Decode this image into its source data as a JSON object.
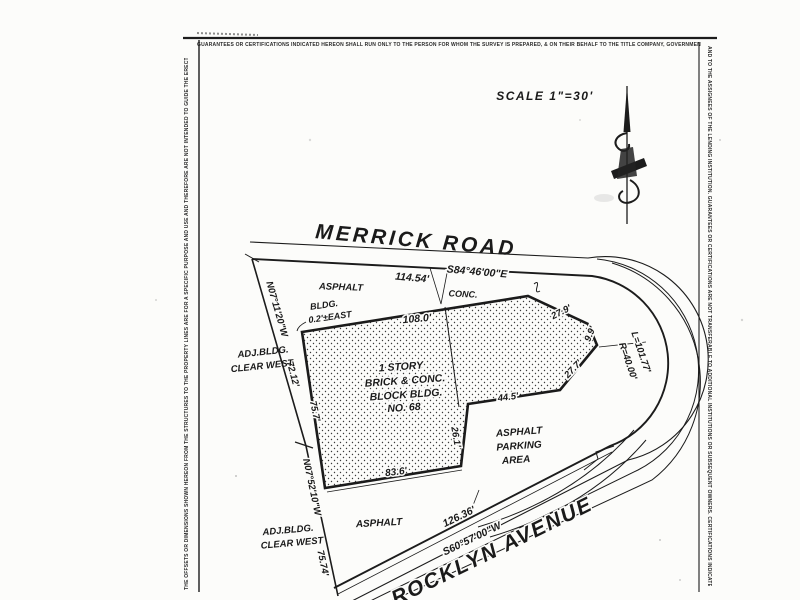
{
  "sheet": {
    "top_disclaimer": "GUARANTEES OR CERTIFICATIONS INDICATED HEREON SHALL RUN ONLY TO THE PERSON FOR WHOM THE SURVEY IS PREPARED, & ON THEIR BEHALF TO THE TITLE COMPANY, GOVERNMENTAL AGENCY & LENDING INSTITUTION LISTED HEREON",
    "left_margin_note": "THE OFFSETS OR DIMENSIONS SHOWN HEREON FROM THE STRUCTURES TO THE PROPERTY LINES ARE FOR A SPECIFIC PURPOSE AND USE AND THEREFORE ARE NOT INTENDED TO GUIDE THE ERECTION OF FENCES, RETAINING WALLS, POOLS, PATIOS, PLANTING AREAS, ADDITIONS TO BUILDINGS & ANY OTHER CONSTRUCTION",
    "right_margin_note": "AND TO THE ASSIGNEES OF THE LENDING INSTITUTION. GUARANTEES OR CERTIFICATIONS ARE NOT TRANSFERABLE TO ADDITIONAL INSTITUTIONS OR SUBSEQUENT OWNERS. CERTIFICATIONS INDICATED HEREON SIGNIFY THAT THIS SURVEY WAS PREPARED IN ACCORDANCE WITH THE EXISTING CODE OF PRACTICE FOR LAND SURVEYS",
    "scale_label": "SCALE 1\"=30'"
  },
  "map": {
    "streets": {
      "merrick_road": "MERRICK ROAD",
      "rocklyn_avenue": "ROCKLYN AVENUE"
    },
    "boundary": {
      "merrick_bearing": "S84°46'00\"E",
      "merrick_distance": "114.54'",
      "west_upper_bearing": "N07°11'20\"W",
      "west_upper_distance": "72.12'",
      "west_lower_bearing": "N07°52'10\"W",
      "west_lower_distance": "75.74'",
      "rocklyn_bearing": "S60°57'00\"W",
      "rocklyn_distance": "126.36'",
      "corner_curve_length": "L=101.77'",
      "corner_curve_radius": "R=40.00'"
    },
    "building": {
      "name_lines": [
        "1 STORY",
        "BRICK & CONC.",
        "BLOCK BLDG.",
        "NO. 68"
      ],
      "front_width": "108.0'",
      "bevel": "27.9'",
      "corner_side": "9.9'",
      "bevel_back": "27.7'",
      "wing_back": "44.5'",
      "wing_depth": "26.1'",
      "rear_width": "83.6'",
      "west_depth": "75.7'"
    },
    "annotations": {
      "bldg_offset": [
        "BLDG.",
        "0.2'±EAST"
      ],
      "adj_bldg_north": [
        "ADJ.BLDG.",
        "CLEAR WEST"
      ],
      "adj_bldg_south": [
        "ADJ.BLDG.",
        "CLEAR WEST"
      ],
      "surface_asphalt_north": "ASPHALT",
      "surface_conc": "CONC.",
      "surface_asphalt_south": "ASPHALT",
      "parking_area": [
        "ASPHALT",
        "PARKING",
        "AREA"
      ]
    },
    "line_color": "#1c1c1c",
    "paper_color": "#fcfcfa"
  }
}
